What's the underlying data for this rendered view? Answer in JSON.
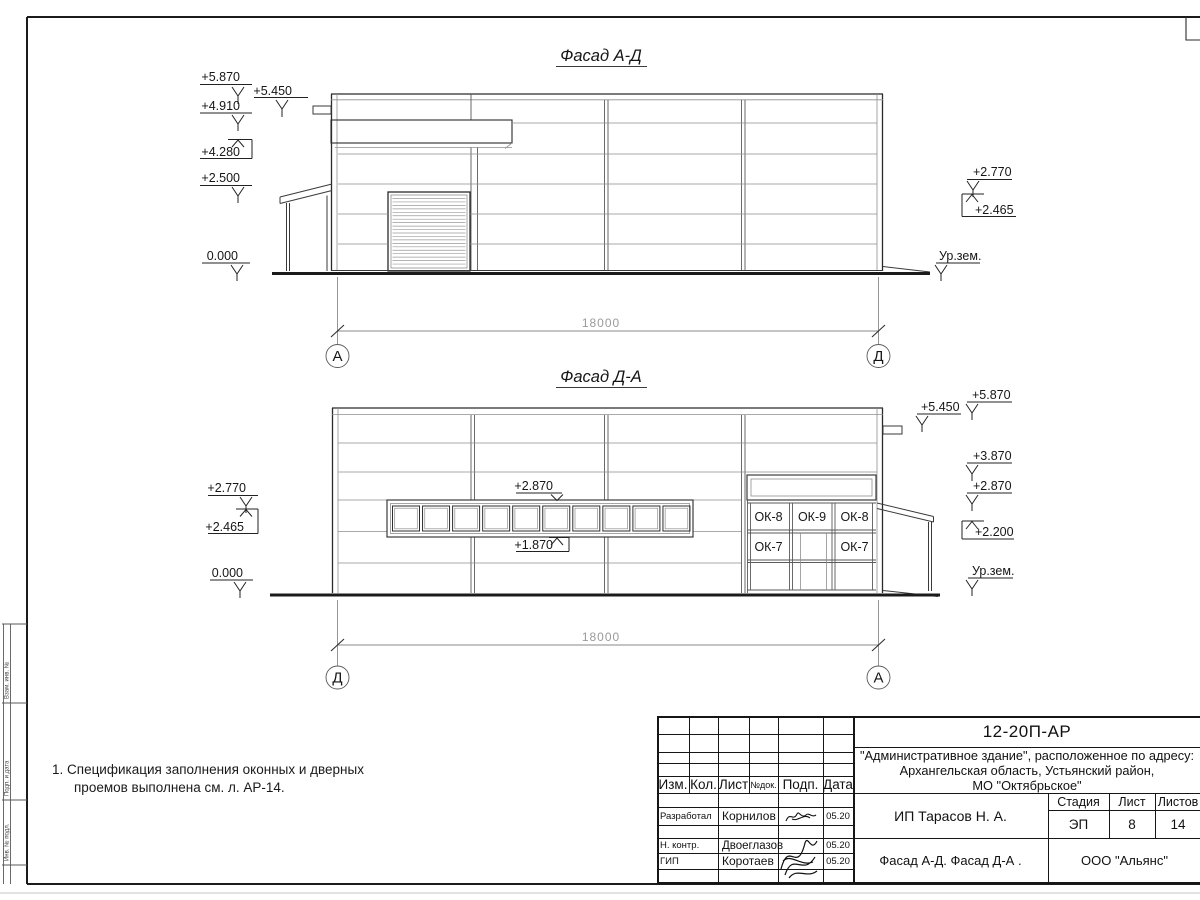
{
  "drawing": {
    "facade_top": {
      "title": "Фасад А-Д",
      "marks_left": [
        "+5.870",
        "+5.450",
        "+4.910",
        "+4.280",
        "+2.500",
        "0.000"
      ],
      "marks_right": [
        "+2.770",
        "+2.465",
        "Ур.зем."
      ]
    },
    "facade_bottom": {
      "title": "Фасад Д-А",
      "marks_left": [
        "+2.770",
        "+2.465",
        "0.000"
      ],
      "marks_center": [
        "+2.870",
        "+1.870"
      ],
      "marks_right": [
        "+5.870",
        "+5.450",
        "+3.870",
        "+2.870",
        "+2.200",
        "Ур.зем."
      ],
      "window_labels": [
        "ОК-8",
        "ОК-9",
        "ОК-8",
        "ОК-7",
        "ОК-7"
      ],
      "ribbon_window_count": 10
    },
    "roller_door_slats": 20,
    "dimension_top": {
      "value": "18000",
      "axis_left": "А",
      "axis_right": "Д"
    },
    "dimension_bottom": {
      "value": "18000",
      "axis_left": "Д",
      "axis_right": "А"
    }
  },
  "notes": {
    "line1": "1. Спецификация заполнения оконных и дверных",
    "line2": "проемов выполнена см. л. АР-14."
  },
  "side_strip": {
    "box1": "Взам. инв. №",
    "box2": "Подп. и дата",
    "box3": "Инв. № подл."
  },
  "title_block": {
    "doc_number": "12-20П-АР",
    "project_line1": "\"Административное здание\", расположенное по адресу:",
    "project_line2": "Архангельская область, Устьянский район,",
    "project_line3": "МО \"Октябрьское\"",
    "header": {
      "izm": "Изм.",
      "kol": "Кол.",
      "list": "Лист",
      "ndok": "№док.",
      "podp": "Подп.",
      "data": "Дата"
    },
    "rows": [
      {
        "role": "Разработал",
        "name": "Корнилов",
        "date": "05.20"
      },
      {
        "role": "Н. контр.",
        "name": "Двоеглазов",
        "date": "05.20"
      },
      {
        "role": "ГИП",
        "name": "Коротаев",
        "date": "05.20"
      }
    ],
    "client": "ИП Тарасов Н. А.",
    "stage_label": "Стадия",
    "sheet_label": "Лист",
    "sheets_label": "Листов",
    "stage": "ЭП",
    "sheet": "8",
    "sheets": "14",
    "sheet_title": "Фасад А-Д. Фасад Д-А .",
    "company": "ООО \"Альянс\""
  }
}
